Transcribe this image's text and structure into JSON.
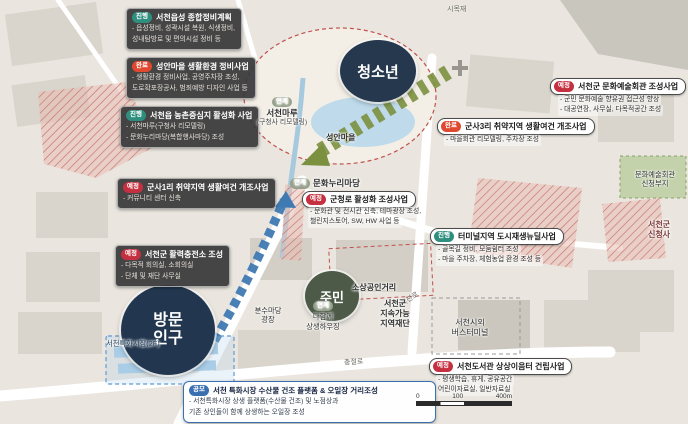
{
  "status_colors": {
    "jinhaeng": "#2f8f7e",
    "wanryo": "#e0492f",
    "yejeong": "#c53040",
    "gongmo": "#3a6fb0",
    "yeongye": "#95a08b",
    "youth_circle": "#26384e",
    "resident_circle": "#4c5a47",
    "visitor_circle": "#22374f"
  },
  "projects": {
    "left": [
      {
        "badge": "진행",
        "title": "서천읍성 종합정비계획",
        "bullets": [
          "- 읍성정비, 성곽시설 복원, 식생정비,",
          "  성내탐방로 및 편의시설 정비 등"
        ]
      },
      {
        "badge": "완료",
        "title": "성안마을 생활환경 정비사업",
        "bullets": [
          "- 생활환경 정비사업, 공영주차장 조성,",
          "  도로확포장공사, 범죄예방 디자인 사업 등"
        ]
      },
      {
        "badge": "진행",
        "title": "서천읍 농촌중심지 활성화 사업",
        "bullets": [
          "- 서천마루(구청사 리모델링)",
          "- 문화누리마당(복합행사마당) 조성"
        ]
      },
      {
        "badge": "예정",
        "title": "군사1리 취약지역 생활여건 개조사업",
        "bullets": [
          "- 커뮤니티 센터 신축"
        ]
      },
      {
        "badge": "예정",
        "title": "서천군 활력충전소 조성",
        "bullets": [
          "- 다목적 회의실, 소회의실",
          "- 단체 및 재단 사무실"
        ]
      }
    ],
    "center": [
      {
        "badge": "예정",
        "title": "군청로 활성화 조성사업",
        "bullets": [
          "- 문화관 및 전시관 신축, 테마광장 조성,",
          "  챌린지스토어, SW, HW 사업 등"
        ]
      },
      {
        "badge": "진행",
        "title": "터미널지역 도시재생뉴딜사업",
        "bullets": [
          "- 골목길 정비, 모둠쉼터 조성",
          "- 마을 주차장, 체험농업 환경 조성 등"
        ]
      }
    ],
    "right": [
      {
        "badge": "예정",
        "title": "서천군 문화예술회관 조성사업",
        "bullets": [
          "- 군민 문화예술 향유권 접근성 향상",
          "- 대공연장, 사무실, 다목적공간 조성"
        ]
      },
      {
        "badge": "완료",
        "title": "군사3리 취약지역 생활여건 개조사업",
        "bullets": [
          "- 마을회관 리모델링, 주차장 조성"
        ]
      },
      {
        "badge": "예정",
        "title": "서천도서관 상상이음터 건립사업",
        "bullets": [
          "- 평생학습, 휴게, 공유공간",
          "  어린이자료실, 일반자료실"
        ]
      }
    ],
    "bottom": {
      "badge": "공모",
      "title": "서천 특화시장 수산물 건조 플랫폼 & 오일장 거리조성",
      "bullets": [
        "- 서천특화시장 상생 플랫폼(수산물 건조) 및 노점상과",
        "  기존 상인들이 함께 상생하는 오일장 조성"
      ]
    }
  },
  "map": {
    "circles": {
      "youth": "청소년",
      "resident": "주민",
      "visitor1": "방문",
      "visitor2": "인구"
    },
    "labels": {
      "maru_badge": "연계",
      "maru1": "서천마루",
      "maru2": "(구청사 리모델링)",
      "seongan": "성안마을",
      "munhwa_badge": "연계",
      "munhwa": "문화누리마당",
      "sosang": "소상공인거리",
      "seocheonro": "서천로",
      "fountain1": "분수마당",
      "fountain2": "광장",
      "housing_badge": "연계",
      "housing1": "다함께",
      "housing2": "상생하우징",
      "foundation1": "서천군",
      "foundation2": "지속가능",
      "foundation3": "지역재단",
      "terminal1": "서천시외",
      "terminal2": "버스터미널",
      "market": "서천특화시장(2F)",
      "artsite1": "문화예술회관",
      "artsite2": "신청부지",
      "newhall1": "서천군",
      "newhall2": "신청사",
      "chungjeolro": "충절로",
      "simokjae": "시목재"
    },
    "scale": {
      "t0": "0",
      "t1": "100",
      "t2": "400m"
    }
  }
}
